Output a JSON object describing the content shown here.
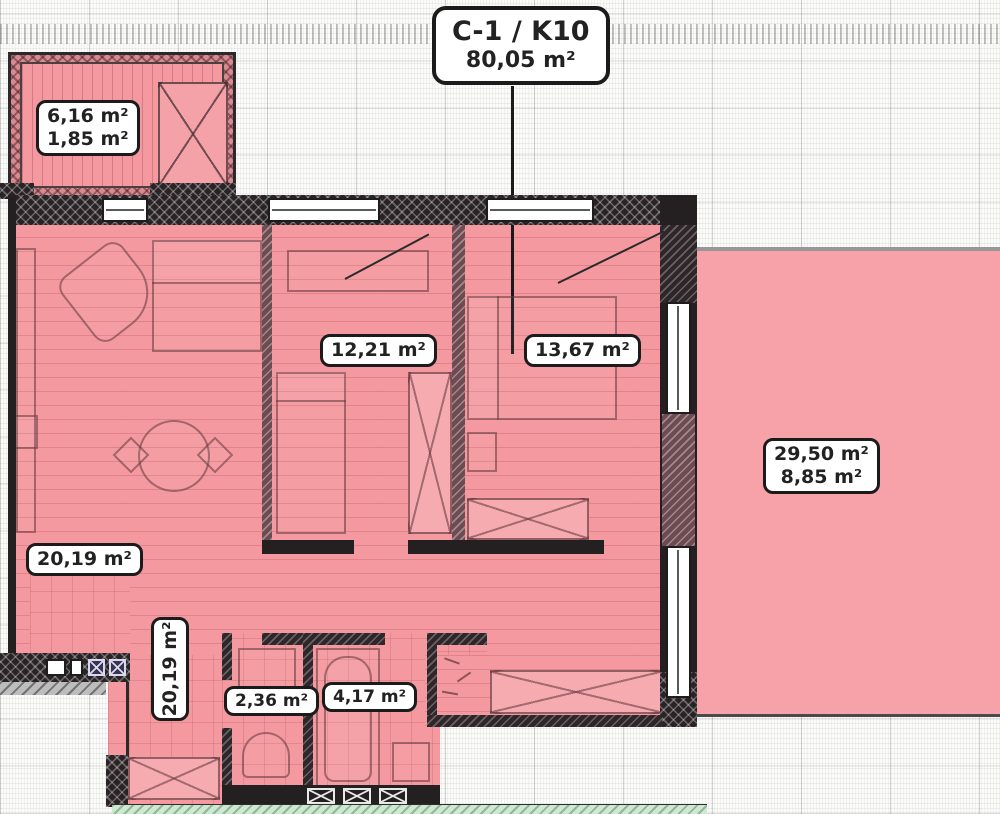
{
  "plan": {
    "title": {
      "code": "C-1 / K10",
      "area": "80,05 m²"
    },
    "unit": "m²",
    "rooms": {
      "balcony": {
        "area_total": "6,16 m²",
        "area_reduced": "1,85 m²"
      },
      "kitchen_living": {
        "area": "20,19 m²"
      },
      "bedroom_1": {
        "area": "12,21 m²"
      },
      "bedroom_2": {
        "area": "13,67 m²"
      },
      "terrace": {
        "area_total": "29,50 m²",
        "area_reduced": "8,85 m²"
      },
      "hallway": {
        "area": "20,19 m²"
      },
      "wc": {
        "area": "2,36 m²"
      },
      "bathroom": {
        "area": "4,17 m²"
      }
    },
    "colors": {
      "room_fill": "#f4999f",
      "terrace_fill": "#f7a2a8",
      "wall": "#241f21",
      "label_bg": "#ffffff",
      "label_border": "#1b1b1b",
      "mint_edge": "#cfe8d2"
    }
  }
}
